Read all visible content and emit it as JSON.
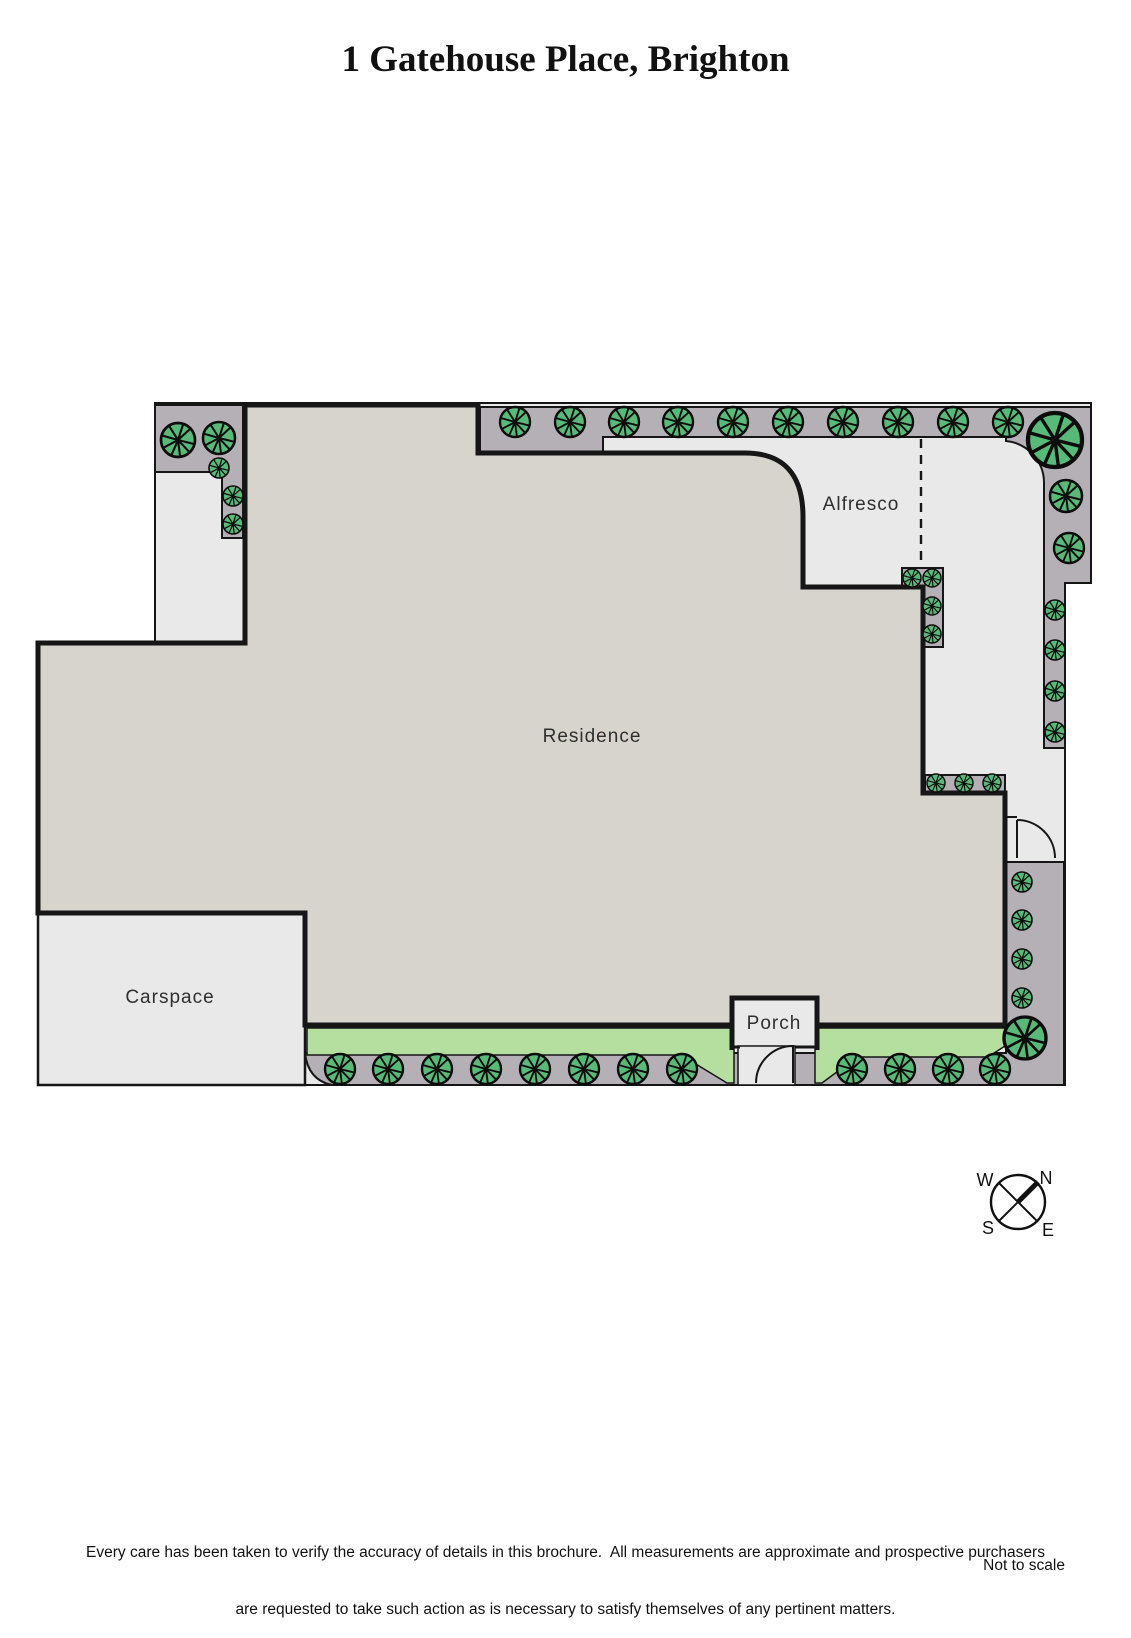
{
  "title": "1 Gatehouse Place, Brighton",
  "plan": {
    "labels": {
      "residence": "Residence",
      "alfresco": "Alfresco",
      "carspace": "Carspace",
      "porch": "Porch"
    },
    "compass": {
      "n": "N",
      "s": "S",
      "e": "E",
      "w": "W"
    },
    "colors": {
      "path": "#e9e9e9",
      "bed": "#b5b0b5",
      "residence": "#d7d3cd",
      "grass": "#b5df9e",
      "tree": "#58ba79",
      "outline": "#161616"
    },
    "trees": [
      [
        178,
        440,
        17
      ],
      [
        219,
        438,
        16
      ],
      [
        219,
        468,
        10
      ],
      [
        233,
        496,
        10
      ],
      [
        233,
        524,
        10
      ],
      [
        515,
        422,
        15
      ],
      [
        570,
        422,
        15
      ],
      [
        624,
        422,
        15
      ],
      [
        678,
        422,
        15
      ],
      [
        733,
        422,
        15
      ],
      [
        788,
        422,
        15
      ],
      [
        843,
        422,
        15
      ],
      [
        898,
        422,
        15
      ],
      [
        953,
        422,
        15
      ],
      [
        1008,
        422,
        15
      ],
      [
        1055,
        440,
        27
      ],
      [
        1066,
        496,
        16
      ],
      [
        1069,
        548,
        15
      ],
      [
        1055,
        610,
        10
      ],
      [
        1055,
        650,
        10
      ],
      [
        1055,
        691,
        10
      ],
      [
        1055,
        732,
        10
      ],
      [
        912,
        578,
        9
      ],
      [
        932,
        578,
        9
      ],
      [
        932,
        606,
        9
      ],
      [
        932,
        634,
        9
      ],
      [
        936,
        783,
        9
      ],
      [
        964,
        783,
        9
      ],
      [
        992,
        783,
        9
      ],
      [
        1022,
        882,
        10
      ],
      [
        1022,
        920,
        10
      ],
      [
        1022,
        959,
        10
      ],
      [
        1022,
        998,
        10
      ],
      [
        1025,
        1038,
        21
      ],
      [
        340,
        1069,
        15
      ],
      [
        388,
        1069,
        15
      ],
      [
        437,
        1069,
        15
      ],
      [
        486,
        1069,
        15
      ],
      [
        535,
        1069,
        15
      ],
      [
        584,
        1069,
        15
      ],
      [
        633,
        1069,
        15
      ],
      [
        682,
        1069,
        15
      ],
      [
        852,
        1069,
        15
      ],
      [
        900,
        1069,
        15
      ],
      [
        948,
        1069,
        15
      ],
      [
        995,
        1069,
        15
      ]
    ]
  },
  "footer": {
    "disclaimer_line1": "Every care has been taken to verify the accuracy of details in this brochure.  All measurements are approximate and prospective purchasers",
    "disclaimer_line2": "are requested to take such action as is necessary to satisfy themselves of any pertinent matters.",
    "not_to_scale": "Not to scale"
  }
}
